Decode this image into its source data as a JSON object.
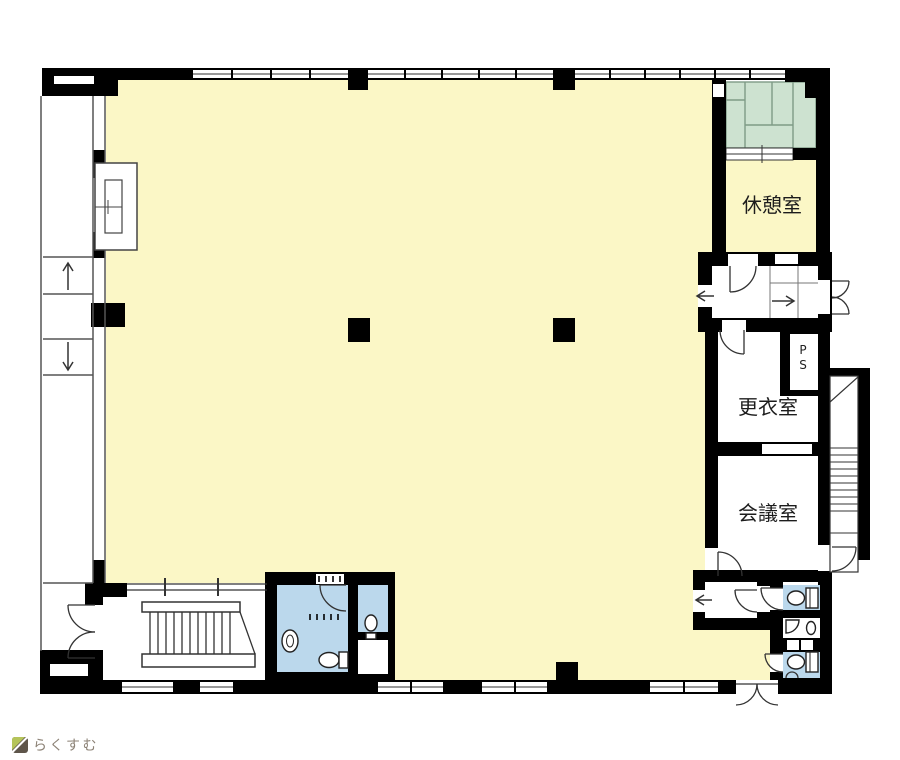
{
  "floorplan": {
    "rooms": {
      "rest_room": {
        "label": "休憩室"
      },
      "dressing_room": {
        "label": "更衣室"
      },
      "meeting_room": {
        "label": "会議室"
      },
      "pipe_shaft": {
        "label": "PS",
        "char_top": "P",
        "char_bottom": "S"
      }
    },
    "colors": {
      "wall": "#000000",
      "floor": "#FBF7C6",
      "tatami": "#CDE2D0",
      "tatami_line": "#7E9B86",
      "wet_area": "#BBD8EC",
      "line": "#333333"
    }
  },
  "footer": {
    "logo_text": "らくすむ",
    "logo_colors": {
      "green": "#B5C45A",
      "dark": "#5E554A",
      "text": "#8C8276"
    }
  }
}
